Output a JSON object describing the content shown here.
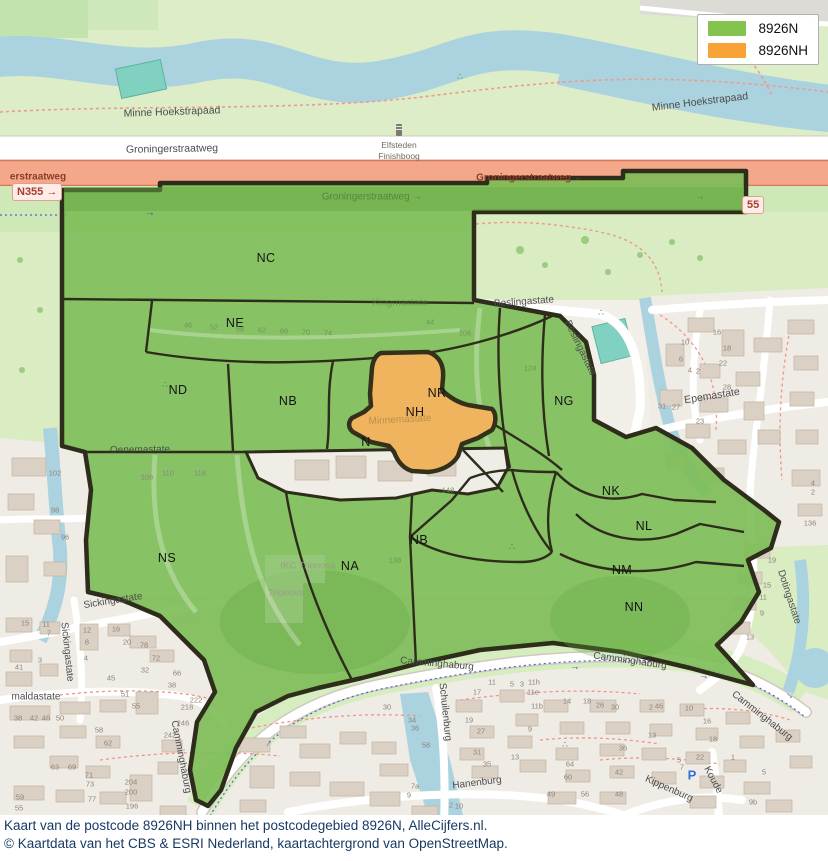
{
  "legend": {
    "items": [
      {
        "label": "8926N",
        "color": "#84c44e"
      },
      {
        "label": "8926NH",
        "color": "#f6a235"
      }
    ]
  },
  "caption": {
    "line1": "Kaart van de postcode 8926NH binnen het postcodegebied 8926N, AlleCijfers.nl.",
    "line2": "© Kaartdata van het CBS & ESRI Nederland, kaartachtergrond van OpenStreetMap."
  },
  "colors": {
    "postcode_area_fill": "#7bbd55",
    "postcode_nh_fill": "#f0b45f",
    "boundary": "#2e2d1b",
    "water": "#aad3df",
    "trunk_road": "#f5a78a"
  },
  "badges": {
    "n355_left": "N355 →",
    "n355_right": "55"
  },
  "poi": {
    "parking": {
      "glyph": "P",
      "x": 692,
      "y": 775
    },
    "elfsteden": {
      "line1": "Elfsteden",
      "line2": "Finishboog"
    }
  },
  "icons": {
    "playground": "∴",
    "cycle_arrow": "→"
  },
  "region_labels": [
    {
      "code": "NC",
      "x": 266,
      "y": 258
    },
    {
      "code": "NE",
      "x": 235,
      "y": 323
    },
    {
      "code": "ND",
      "x": 178,
      "y": 390
    },
    {
      "code": "NB",
      "x": 288,
      "y": 401
    },
    {
      "code": "NR",
      "x": 437,
      "y": 393
    },
    {
      "code": "NH",
      "x": 415,
      "y": 412
    },
    {
      "code": "N",
      "x": 366,
      "y": 442
    },
    {
      "code": "NG",
      "x": 564,
      "y": 401
    },
    {
      "code": "NK",
      "x": 611,
      "y": 491
    },
    {
      "code": "NL",
      "x": 644,
      "y": 526
    },
    {
      "code": "NM",
      "x": 622,
      "y": 570
    },
    {
      "code": "NN",
      "x": 634,
      "y": 607
    },
    {
      "code": "NB",
      "x": 419,
      "y": 540
    },
    {
      "code": "NS",
      "x": 167,
      "y": 558
    },
    {
      "code": "NA",
      "x": 350,
      "y": 566
    }
  ],
  "street_labels": [
    {
      "text": "Minne Hoekstrapaad",
      "x": 172,
      "y": 112,
      "rot": -2,
      "cls": "big"
    },
    {
      "text": "Minne Hoekstrapaad",
      "x": 700,
      "y": 102,
      "rot": -7,
      "cls": "big"
    },
    {
      "text": "Groningerstraatweg",
      "x": 172,
      "y": 149,
      "rot": -1,
      "cls": "big"
    },
    {
      "text": "erstraatweg",
      "x": 38,
      "y": 177,
      "rot": 0,
      "cls": "trunk"
    },
    {
      "text": "Groningerstraatweg ←",
      "x": 530,
      "y": 178,
      "rot": 0,
      "cls": "trunk"
    },
    {
      "text": "Groningerstraatweg →",
      "x": 372,
      "y": 197,
      "rot": 0,
      "cls": "greenway"
    },
    {
      "text": "→",
      "x": 700,
      "y": 197,
      "rot": 0,
      "cls": "greenway"
    },
    {
      "text": "Beslingastate",
      "x": 524,
      "y": 302,
      "rot": -4,
      "cls": ""
    },
    {
      "text": "Beslingastate",
      "x": 580,
      "y": 348,
      "rot": 64,
      "cls": ""
    },
    {
      "text": "Kingmastate",
      "x": 400,
      "y": 303,
      "rot": 0,
      "cls": "faint"
    },
    {
      "text": "Minnemastate",
      "x": 400,
      "y": 420,
      "rot": -3,
      "cls": "fainto"
    },
    {
      "text": "Epemastate",
      "x": 712,
      "y": 396,
      "rot": -9,
      "cls": "big"
    },
    {
      "text": "Oenemastate",
      "x": 140,
      "y": 450,
      "rot": -1,
      "cls": "dark"
    },
    {
      "text": "Sickingastate",
      "x": 113,
      "y": 601,
      "rot": -9,
      "cls": ""
    },
    {
      "text": "Sickingastate",
      "x": 67,
      "y": 652,
      "rot": 84,
      "cls": ""
    },
    {
      "text": "maldastate",
      "x": 36,
      "y": 697,
      "rot": 0,
      "cls": ""
    },
    {
      "text": "Camminghaburg",
      "x": 437,
      "y": 664,
      "rot": 5,
      "cls": ""
    },
    {
      "text": "Camminghaburg",
      "x": 630,
      "y": 661,
      "rot": 8,
      "cls": ""
    },
    {
      "text": "Camminghaburg",
      "x": 762,
      "y": 716,
      "rot": 38,
      "cls": ""
    },
    {
      "text": "Camminghaburg",
      "x": 181,
      "y": 757,
      "rot": 79,
      "cls": ""
    },
    {
      "text": "Schuilenburg",
      "x": 445,
      "y": 712,
      "rot": 84,
      "cls": ""
    },
    {
      "text": "Hanenburg",
      "x": 477,
      "y": 783,
      "rot": -7,
      "cls": ""
    },
    {
      "text": "Kippenburg",
      "x": 669,
      "y": 789,
      "rot": 24,
      "cls": ""
    },
    {
      "text": "Koude",
      "x": 713,
      "y": 780,
      "rot": 62,
      "cls": ""
    },
    {
      "text": "Dotingastate",
      "x": 789,
      "y": 597,
      "rot": 72,
      "cls": ""
    }
  ],
  "landuse_labels": [
    {
      "text": "IKC Trionova",
      "x": 308,
      "y": 566,
      "cls": ""
    },
    {
      "text": "Trionova",
      "x": 286,
      "y": 593,
      "cls": ""
    },
    {
      "text": "hoven",
      "x": 186,
      "y": 620,
      "cls": "vfaint"
    }
  ],
  "house_numbers": [
    {
      "t": "16",
      "x": 717,
      "y": 332
    },
    {
      "t": "10",
      "x": 685,
      "y": 342
    },
    {
      "t": "18",
      "x": 727,
      "y": 348
    },
    {
      "t": "6",
      "x": 681,
      "y": 359
    },
    {
      "t": "22",
      "x": 723,
      "y": 363
    },
    {
      "t": "4",
      "x": 690,
      "y": 370
    },
    {
      "t": "2",
      "x": 698,
      "y": 371
    },
    {
      "t": "28",
      "x": 727,
      "y": 387
    },
    {
      "t": "31",
      "x": 662,
      "y": 406
    },
    {
      "t": "27",
      "x": 676,
      "y": 407
    },
    {
      "t": "23",
      "x": 700,
      "y": 421
    },
    {
      "t": "4",
      "x": 813,
      "y": 483
    },
    {
      "t": "2",
      "x": 813,
      "y": 492
    },
    {
      "t": "136",
      "x": 810,
      "y": 523
    },
    {
      "t": "19",
      "x": 772,
      "y": 560
    },
    {
      "t": "15",
      "x": 767,
      "y": 585
    },
    {
      "t": "11",
      "x": 763,
      "y": 597
    },
    {
      "t": "9",
      "x": 762,
      "y": 613
    },
    {
      "t": "13",
      "x": 750,
      "y": 637
    },
    {
      "t": "102",
      "x": 55,
      "y": 473
    },
    {
      "t": "98",
      "x": 55,
      "y": 510
    },
    {
      "t": "96",
      "x": 65,
      "y": 537
    },
    {
      "t": "106",
      "x": 147,
      "y": 477
    },
    {
      "t": "110",
      "x": 168,
      "y": 473
    },
    {
      "t": "118",
      "x": 200,
      "y": 473
    },
    {
      "t": "15",
      "x": 25,
      "y": 623
    },
    {
      "t": "11",
      "x": 46,
      "y": 624
    },
    {
      "t": "7",
      "x": 49,
      "y": 633
    },
    {
      "t": "3",
      "x": 40,
      "y": 660
    },
    {
      "t": "41",
      "x": 19,
      "y": 667
    },
    {
      "t": "12",
      "x": 87,
      "y": 630
    },
    {
      "t": "8",
      "x": 87,
      "y": 642
    },
    {
      "t": "4",
      "x": 86,
      "y": 658
    },
    {
      "t": "16",
      "x": 116,
      "y": 629
    },
    {
      "t": "20",
      "x": 127,
      "y": 642
    },
    {
      "t": "78",
      "x": 144,
      "y": 645
    },
    {
      "t": "72",
      "x": 156,
      "y": 658
    },
    {
      "t": "45",
      "x": 111,
      "y": 678
    },
    {
      "t": "32",
      "x": 145,
      "y": 670
    },
    {
      "t": "66",
      "x": 177,
      "y": 673
    },
    {
      "t": "38",
      "x": 172,
      "y": 685
    },
    {
      "t": "51",
      "x": 125,
      "y": 694
    },
    {
      "t": "55",
      "x": 136,
      "y": 706
    },
    {
      "t": "222",
      "x": 196,
      "y": 700
    },
    {
      "t": "218",
      "x": 187,
      "y": 707
    },
    {
      "t": "246",
      "x": 183,
      "y": 723
    },
    {
      "t": "242",
      "x": 170,
      "y": 735
    },
    {
      "t": "58",
      "x": 99,
      "y": 730
    },
    {
      "t": "62",
      "x": 108,
      "y": 743
    },
    {
      "t": "63",
      "x": 55,
      "y": 767
    },
    {
      "t": "69",
      "x": 72,
      "y": 767
    },
    {
      "t": "71",
      "x": 89,
      "y": 775
    },
    {
      "t": "73",
      "x": 90,
      "y": 784
    },
    {
      "t": "77",
      "x": 92,
      "y": 799
    },
    {
      "t": "204",
      "x": 131,
      "y": 782
    },
    {
      "t": "200",
      "x": 131,
      "y": 792
    },
    {
      "t": "196",
      "x": 132,
      "y": 806
    },
    {
      "t": "38",
      "x": 18,
      "y": 718
    },
    {
      "t": "42",
      "x": 34,
      "y": 718
    },
    {
      "t": "46",
      "x": 46,
      "y": 718
    },
    {
      "t": "50",
      "x": 60,
      "y": 718
    },
    {
      "t": "59",
      "x": 20,
      "y": 797
    },
    {
      "t": "55",
      "x": 19,
      "y": 808
    },
    {
      "t": "30",
      "x": 387,
      "y": 707
    },
    {
      "t": "34",
      "x": 412,
      "y": 720
    },
    {
      "t": "36",
      "x": 415,
      "y": 728
    },
    {
      "t": "58",
      "x": 426,
      "y": 745
    },
    {
      "t": "17",
      "x": 477,
      "y": 692
    },
    {
      "t": "11",
      "x": 492,
      "y": 682
    },
    {
      "t": "5",
      "x": 512,
      "y": 684
    },
    {
      "t": "3",
      "x": 522,
      "y": 684
    },
    {
      "t": "11h",
      "x": 534,
      "y": 682
    },
    {
      "t": "11e",
      "x": 533,
      "y": 692
    },
    {
      "t": "11b",
      "x": 537,
      "y": 706
    },
    {
      "t": "19",
      "x": 469,
      "y": 720
    },
    {
      "t": "27",
      "x": 481,
      "y": 731
    },
    {
      "t": "31",
      "x": 477,
      "y": 752
    },
    {
      "t": "35",
      "x": 487,
      "y": 764
    },
    {
      "t": "9",
      "x": 530,
      "y": 729
    },
    {
      "t": "13",
      "x": 515,
      "y": 757
    },
    {
      "t": "49",
      "x": 551,
      "y": 794
    },
    {
      "t": "14",
      "x": 567,
      "y": 701
    },
    {
      "t": "18",
      "x": 587,
      "y": 701
    },
    {
      "t": "26",
      "x": 600,
      "y": 705
    },
    {
      "t": "30",
      "x": 615,
      "y": 707
    },
    {
      "t": "64",
      "x": 570,
      "y": 764
    },
    {
      "t": "60",
      "x": 568,
      "y": 777
    },
    {
      "t": "56",
      "x": 585,
      "y": 794
    },
    {
      "t": "36",
      "x": 623,
      "y": 748
    },
    {
      "t": "42",
      "x": 619,
      "y": 772
    },
    {
      "t": "48",
      "x": 619,
      "y": 794
    },
    {
      "t": "7a",
      "x": 415,
      "y": 786
    },
    {
      "t": "9",
      "x": 409,
      "y": 795
    },
    {
      "t": "2",
      "x": 451,
      "y": 805
    },
    {
      "t": "10",
      "x": 459,
      "y": 806
    },
    {
      "t": "2",
      "x": 651,
      "y": 707
    },
    {
      "t": "46",
      "x": 659,
      "y": 706
    },
    {
      "t": "10",
      "x": 689,
      "y": 708
    },
    {
      "t": "16",
      "x": 707,
      "y": 721
    },
    {
      "t": "13",
      "x": 652,
      "y": 735
    },
    {
      "t": "18",
      "x": 713,
      "y": 739
    },
    {
      "t": "22",
      "x": 700,
      "y": 757
    },
    {
      "t": "5",
      "x": 679,
      "y": 760
    },
    {
      "t": "7",
      "x": 682,
      "y": 767
    },
    {
      "t": "1",
      "x": 733,
      "y": 757
    },
    {
      "t": "5",
      "x": 764,
      "y": 772
    },
    {
      "t": "9b",
      "x": 753,
      "y": 802
    },
    {
      "t": "46",
      "x": 188,
      "y": 325,
      "g": 1
    },
    {
      "t": "52",
      "x": 214,
      "y": 327,
      "g": 1
    },
    {
      "t": "58",
      "x": 240,
      "y": 329,
      "g": 1
    },
    {
      "t": "62",
      "x": 262,
      "y": 330,
      "g": 1
    },
    {
      "t": "66",
      "x": 284,
      "y": 331,
      "g": 1
    },
    {
      "t": "70",
      "x": 306,
      "y": 332,
      "g": 1
    },
    {
      "t": "74",
      "x": 328,
      "y": 333,
      "g": 1
    },
    {
      "t": "106",
      "x": 465,
      "y": 333,
      "g": 1
    },
    {
      "t": "124",
      "x": 530,
      "y": 368,
      "g": 1
    },
    {
      "t": "148",
      "x": 448,
      "y": 490,
      "g": 1
    },
    {
      "t": "138",
      "x": 395,
      "y": 560,
      "g": 1
    },
    {
      "t": "44",
      "x": 430,
      "y": 322,
      "g": 1
    }
  ],
  "arrows": [
    {
      "x": 575,
      "y": 667,
      "rot": 5
    },
    {
      "x": 268,
      "y": 743,
      "rot": -55
    },
    {
      "x": 704,
      "y": 676,
      "rot": 12
    },
    {
      "x": 150,
      "y": 213,
      "rot": 0
    },
    {
      "x": 790,
      "y": 695,
      "rot": 40
    }
  ],
  "playgrounds": [
    {
      "x": 165,
      "y": 385
    },
    {
      "x": 460,
      "y": 77
    },
    {
      "x": 601,
      "y": 313
    },
    {
      "x": 512,
      "y": 547
    },
    {
      "x": 565,
      "y": 745
    }
  ]
}
